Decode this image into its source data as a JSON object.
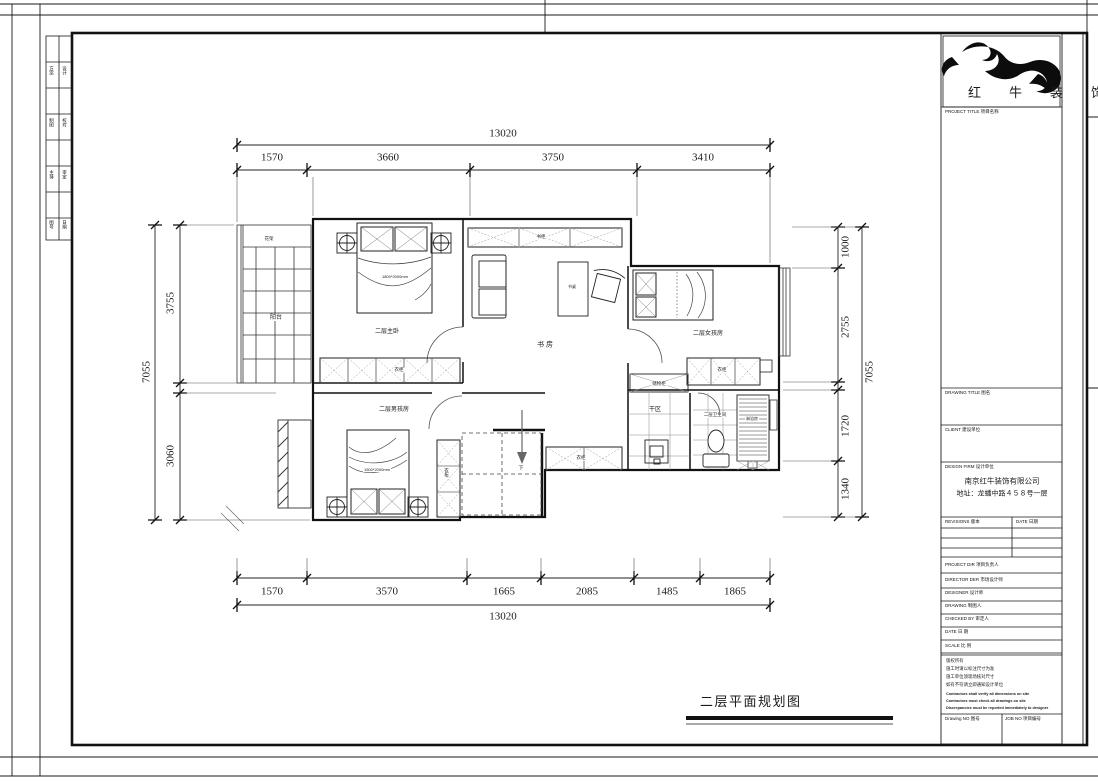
{
  "sheet": {
    "caption": "二层平面规划图"
  },
  "logo": {
    "text": "红牛装饰"
  },
  "title_block": {
    "project_title": "PROJECT TITLE 项目名称",
    "drawing_title": "DRAWING TITLE 图名",
    "client": "CLIENT 建设单位",
    "design_firm": "DESIGN FIRM 设计单位",
    "firm_name": "南京红牛装饰有限公司",
    "firm_address": "地址：龙蟠中路４５８号一层",
    "revisions": "REVISIONS 版本",
    "date_col": "DATE 日期",
    "project_dir": "PROJECT DIR 项目负责人",
    "director": "DIRECTOR DER 市场设计师",
    "designer": "DESIGNER 设计师",
    "drawing": "DRAWING 制图人",
    "checked_by": "CHECKED BY 审定人",
    "date": "DATE 日 期",
    "scale": "SCALE 比 例",
    "notes_cn": [
      "版权所有",
      "施工时请以标注尺寸为准",
      "施工单位须现场核对尺寸",
      "如有不符请立即通知设计单位"
    ],
    "notes_en": [
      "Contractors shall verify all dimensions on site",
      "Contractors must check all drawings on site",
      "Discrepancies must be reported immediately to designer"
    ],
    "drawing_no": "Drawing NO 图号",
    "job_no": "JOB NO 项目编号"
  },
  "binding_strip": {
    "cells": [
      "方案",
      "设计",
      "制图",
      "校对",
      "主持",
      "审定",
      "图号",
      "日期"
    ]
  },
  "plan": {
    "rooms": {
      "flower_rack": "花架",
      "balcony": "阳台",
      "master_bedroom": "二层主卧",
      "study": "书 房",
      "girls_room": "二层女孩房",
      "boys_room": "二层男孩房",
      "dry_area": "干区",
      "bathroom": "二层卫生间",
      "stairs_down": "下"
    },
    "furniture": {
      "master_wardrobe": "衣柜",
      "bookcase": "书柜",
      "desk": "书桌",
      "girls_wardrobe": "衣柜",
      "storage_cabinet": "储物柜",
      "hall_cabinet": "衣柜",
      "boys_wardrobe": "衣柜",
      "shower_room": "淋浴房",
      "master_bed_size": "1800*2000mm",
      "boys_bed_size": "1500*2000mm"
    }
  },
  "dimensions": {
    "top": {
      "total": "13020",
      "segments": [
        "1570",
        "3660",
        "3750",
        "3410"
      ]
    },
    "bottom": {
      "total": "13020",
      "segments": [
        "1570",
        "3570",
        "1665",
        "2085",
        "1485",
        "1865"
      ]
    },
    "left": {
      "total": "7055",
      "segments": [
        "3755",
        "3060"
      ]
    },
    "right": {
      "total": "7055",
      "segments": [
        "1000",
        "2755",
        "1720",
        "1340"
      ]
    }
  }
}
